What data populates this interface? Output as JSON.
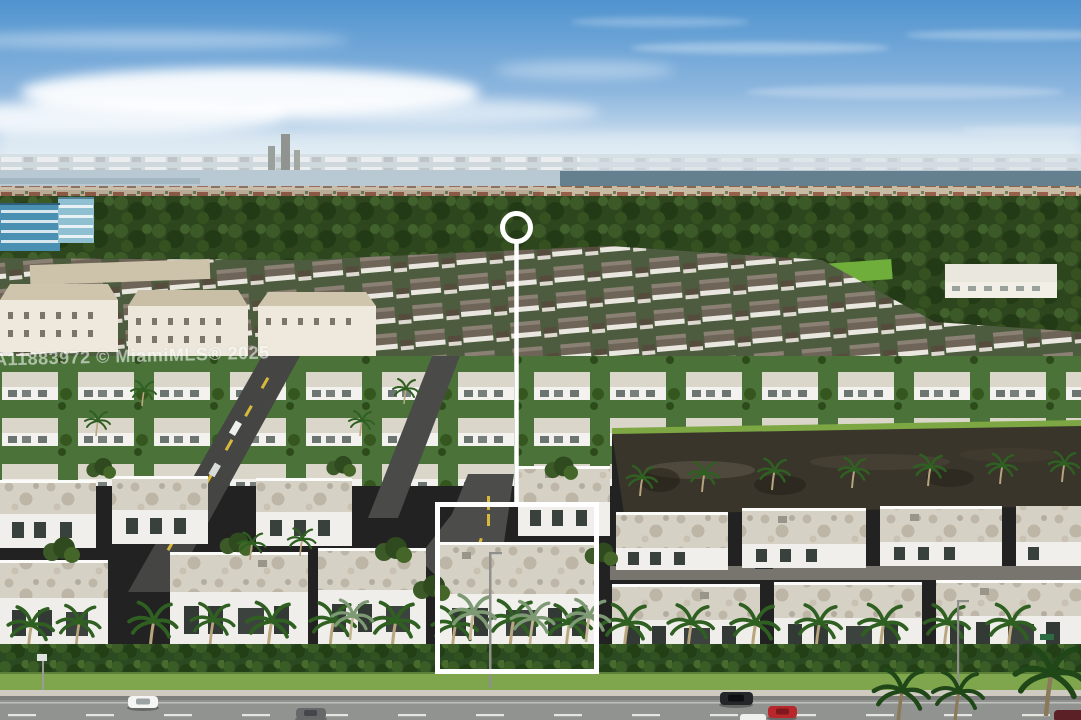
{
  "photo": {
    "kind": "aerial-drone-photo",
    "subject": "modern white flat-roof townhome community with lake, palm trees and highway in foreground"
  },
  "watermark": {
    "text": "A11883972 © MiamiMLS® 2025",
    "color": "#ffffff",
    "opacity": "0.55"
  },
  "annotation": {
    "color": "#ffffff",
    "circle": {
      "cx": "516.5",
      "cy": "227.5",
      "r": "14"
    },
    "line": {
      "x1": "516.5",
      "y1": "243.5",
      "x2": "516.5",
      "y2": "504"
    },
    "box": {
      "x": "437.5",
      "y": "504.5",
      "width": "159",
      "height": "167"
    }
  },
  "scene": {
    "palette": {
      "sky_top": "#4f93cf",
      "sky_mid": "#8cb6de",
      "sky_horizon": "#e3edf4",
      "far_water": "#64808f",
      "near_water": "#3a352b",
      "foliage": "#2e461e",
      "lawn": "#7fa64d",
      "roof_light": "#d6d1c5",
      "wall_white": "#f1f0ec",
      "roof_dark": "#6e6458",
      "asphalt": "#454644",
      "highway": "#919390",
      "sidewalk": "#cfcbc1",
      "hedge": "#2c4a22"
    },
    "vehicles": [
      {
        "name": "white-car",
        "color": "#f5f5f3"
      },
      {
        "name": "gray-sedan",
        "color": "#66686a"
      },
      {
        "name": "black-suv",
        "color": "#24262a"
      },
      {
        "name": "red-car",
        "color": "#b8272b"
      },
      {
        "name": "white-car-edge",
        "color": "#eef0ee"
      },
      {
        "name": "maroon-car-corner",
        "color": "#5a2026"
      }
    ]
  }
}
